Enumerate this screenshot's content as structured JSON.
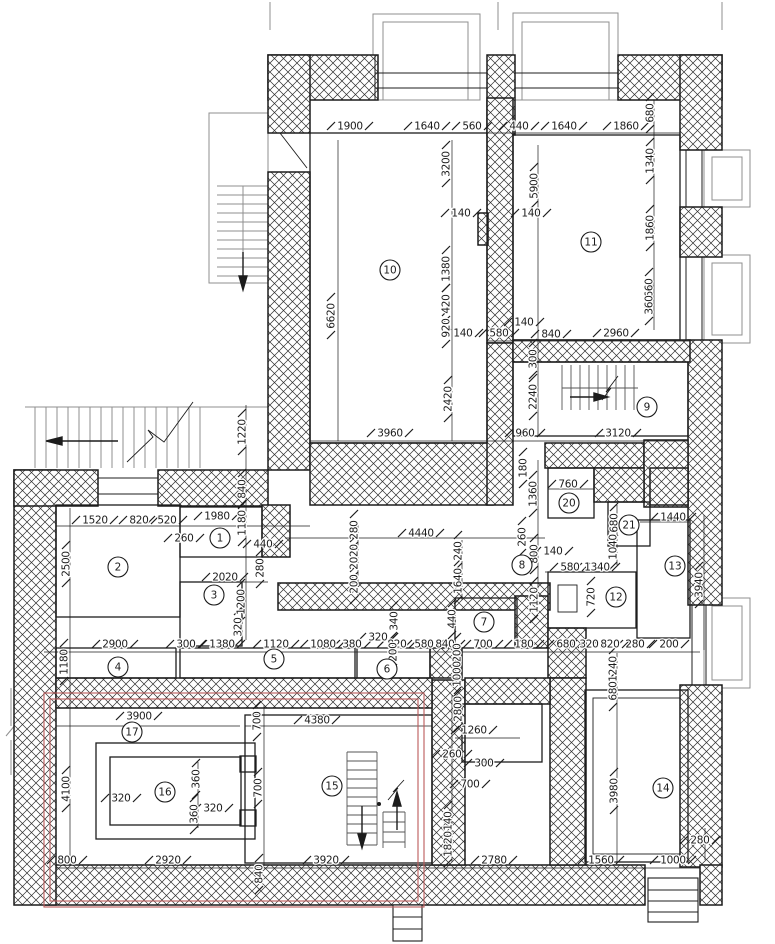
{
  "drawing": {
    "type": "architectural-floor-plan",
    "units": "mm"
  },
  "colors": {
    "wall_line": "#1c1c1c",
    "hatch_line": "#2e2e2e",
    "gray_line": "#8f8f8f",
    "red_route": "#bb5a5a"
  },
  "rooms": [
    [
      "1",
      220,
      538
    ],
    [
      "2",
      118,
      567
    ],
    [
      "3",
      214,
      595
    ],
    [
      "4",
      118,
      667
    ],
    [
      "5",
      274,
      659
    ],
    [
      "6",
      387,
      669
    ],
    [
      "7",
      484,
      622
    ],
    [
      "8",
      522,
      565
    ],
    [
      "9",
      647,
      407
    ],
    [
      "10",
      390,
      270
    ],
    [
      "11",
      591,
      242
    ],
    [
      "12",
      616,
      597
    ],
    [
      "13",
      675,
      566
    ],
    [
      "14",
      663,
      788
    ],
    [
      "15",
      332,
      786
    ],
    [
      "16",
      165,
      792
    ],
    [
      "17",
      132,
      732
    ],
    [
      "20",
      569,
      503
    ],
    [
      "21",
      629,
      525
    ]
  ],
  "dims": [
    [
      "1900",
      350,
      126,
      0
    ],
    [
      "1640",
      427,
      126,
      0
    ],
    [
      "560",
      472,
      126,
      0
    ],
    [
      "440",
      519,
      126,
      0
    ],
    [
      "1640",
      564,
      126,
      0
    ],
    [
      "1860",
      626,
      126,
      0
    ],
    [
      "680",
      650,
      113,
      1
    ],
    [
      "1340",
      650,
      161,
      1
    ],
    [
      "1860",
      650,
      228,
      1
    ],
    [
      "660",
      649,
      288,
      1
    ],
    [
      "360",
      649,
      305,
      1
    ],
    [
      "5900",
      534,
      186,
      1
    ],
    [
      "3200",
      446,
      164,
      1
    ],
    [
      "140",
      461,
      213,
      0
    ],
    [
      "140",
      531,
      213,
      0
    ],
    [
      "1380",
      446,
      269,
      1
    ],
    [
      "420",
      446,
      304,
      1
    ],
    [
      "920",
      446,
      328,
      1
    ],
    [
      "6620",
      331,
      316,
      1
    ],
    [
      "140",
      463,
      333,
      0
    ],
    [
      "580",
      499,
      333,
      0
    ],
    [
      "140",
      524,
      322,
      0
    ],
    [
      "840",
      551,
      334,
      0
    ],
    [
      "2960",
      616,
      333,
      0
    ],
    [
      "2420",
      448,
      399,
      1
    ],
    [
      "300",
      533,
      359,
      1
    ],
    [
      "2240",
      533,
      397,
      1
    ],
    [
      "960",
      525,
      433,
      0
    ],
    [
      "3120",
      618,
      433,
      0
    ],
    [
      "3960",
      390,
      433,
      0
    ],
    [
      "1220",
      242,
      432,
      1
    ],
    [
      "840",
      242,
      489,
      1
    ],
    [
      "1180",
      242,
      523,
      1
    ],
    [
      "1520",
      95,
      520,
      0
    ],
    [
      "820",
      139,
      520,
      0
    ],
    [
      "520",
      167,
      520,
      0
    ],
    [
      "1980",
      217,
      516,
      0
    ],
    [
      "260",
      184,
      538,
      0
    ],
    [
      "440",
      263,
      544,
      0
    ],
    [
      "2500",
      66,
      564,
      1
    ],
    [
      "2020",
      225,
      577,
      0
    ],
    [
      "1200",
      241,
      602,
      1
    ],
    [
      "320",
      238,
      627,
      1
    ],
    [
      "280",
      260,
      568,
      1
    ],
    [
      "280",
      354,
      530,
      1
    ],
    [
      "2020",
      354,
      557,
      1
    ],
    [
      "200",
      354,
      584,
      1
    ],
    [
      "4440",
      421,
      533,
      0
    ],
    [
      "240",
      458,
      551,
      1
    ],
    [
      "1640",
      458,
      581,
      1
    ],
    [
      "180",
      523,
      468,
      1
    ],
    [
      "1360",
      533,
      494,
      1
    ],
    [
      "760",
      568,
      484,
      0
    ],
    [
      "260",
      522,
      537,
      1
    ],
    [
      "800",
      534,
      554,
      1
    ],
    [
      "140",
      553,
      551,
      0
    ],
    [
      "580",
      570,
      567,
      0
    ],
    [
      "1340",
      597,
      567,
      0
    ],
    [
      "680",
      614,
      523,
      1
    ],
    [
      "1040",
      613,
      547,
      1
    ],
    [
      "1440",
      673,
      517,
      0
    ],
    [
      "3940",
      699,
      585,
      1
    ],
    [
      "720",
      591,
      597,
      1
    ],
    [
      "1120",
      534,
      600,
      1
    ],
    [
      "340",
      394,
      621,
      1
    ],
    [
      "440",
      452,
      619,
      1
    ],
    [
      "2900",
      115,
      644,
      0
    ],
    [
      "300",
      186,
      644,
      0
    ],
    [
      "1380",
      222,
      644,
      0
    ],
    [
      "1120",
      276,
      644,
      0
    ],
    [
      "1080",
      323,
      644,
      0
    ],
    [
      "380",
      352,
      644,
      0
    ],
    [
      "320",
      378,
      637,
      0
    ],
    [
      "820",
      397,
      644,
      0
    ],
    [
      "580",
      424,
      644,
      0
    ],
    [
      "840",
      445,
      644,
      0
    ],
    [
      "700",
      483,
      644,
      0
    ],
    [
      "180",
      524,
      644,
      0
    ],
    [
      "680",
      566,
      644,
      0
    ],
    [
      "320",
      589,
      644,
      0
    ],
    [
      "820",
      610,
      644,
      0
    ],
    [
      "280",
      635,
      644,
      0
    ],
    [
      "200",
      669,
      644,
      0
    ],
    [
      "1180",
      64,
      662,
      1
    ],
    [
      "200",
      393,
      652,
      1
    ],
    [
      "200",
      457,
      653,
      1
    ],
    [
      "1000",
      457,
      674,
      1
    ],
    [
      "1240",
      613,
      669,
      1
    ],
    [
      "680",
      613,
      691,
      1
    ],
    [
      "2800",
      458,
      709,
      1
    ],
    [
      "1260",
      474,
      730,
      0
    ],
    [
      "260",
      452,
      754,
      0
    ],
    [
      "300",
      484,
      763,
      0
    ],
    [
      "700",
      470,
      784,
      0
    ],
    [
      "140",
      448,
      821,
      1
    ],
    [
      "1820",
      448,
      844,
      1
    ],
    [
      "3920",
      326,
      860,
      0
    ],
    [
      "2780",
      494,
      860,
      0
    ],
    [
      "4380",
      317,
      720,
      0
    ],
    [
      "3900",
      139,
      716,
      0
    ],
    [
      "700",
      257,
      721,
      1
    ],
    [
      "4100",
      66,
      789,
      1
    ],
    [
      "320",
      121,
      798,
      0
    ],
    [
      "360",
      196,
      779,
      1
    ],
    [
      "360",
      194,
      814,
      1
    ],
    [
      "320",
      213,
      808,
      0
    ],
    [
      "700",
      258,
      788,
      1
    ],
    [
      "2920",
      168,
      860,
      0
    ],
    [
      "800",
      67,
      860,
      0
    ],
    [
      "840",
      259,
      874,
      1
    ],
    [
      "3980",
      614,
      791,
      1
    ],
    [
      "280",
      700,
      840,
      0
    ],
    [
      "1560",
      601,
      860,
      0
    ],
    [
      "1000",
      673,
      860,
      0
    ]
  ]
}
